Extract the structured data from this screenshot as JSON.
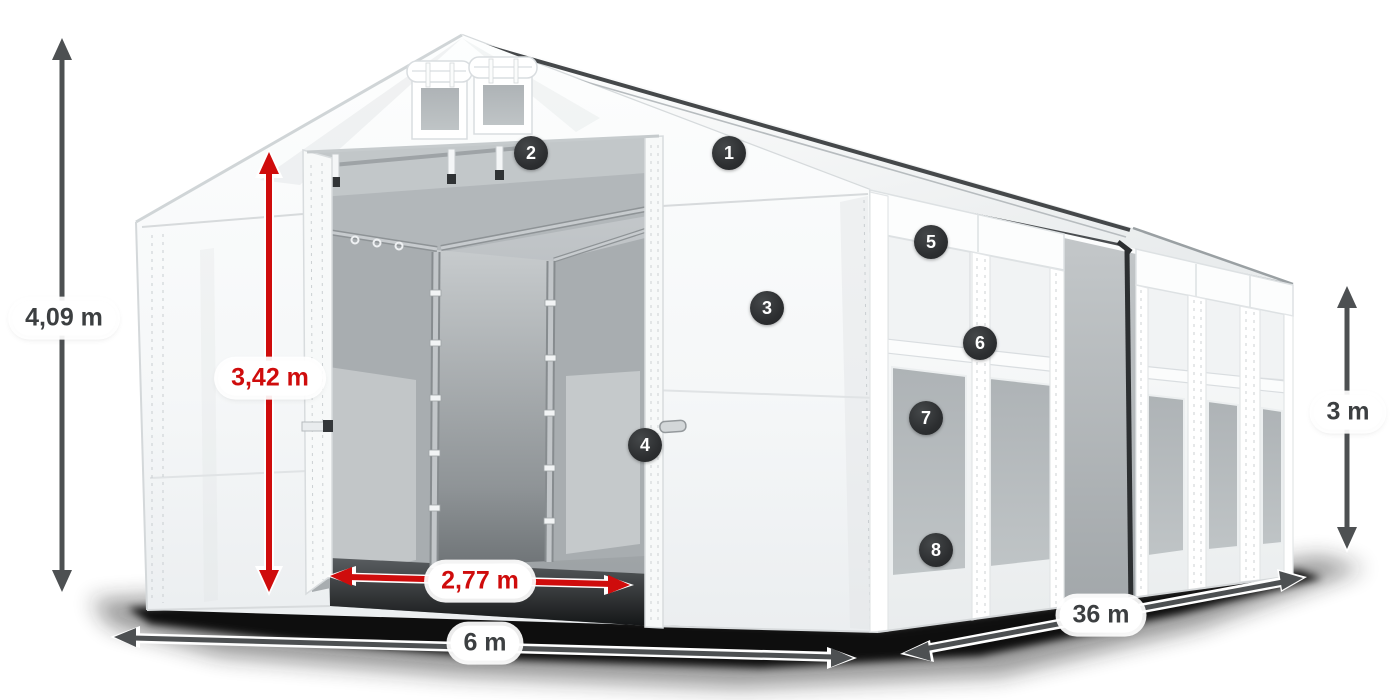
{
  "labels": {
    "total_height": "4,09 m",
    "entrance_height": "3,42 m",
    "entrance_width": "2,77 m",
    "width": "6 m",
    "length": "36 m",
    "side_height": "3 m"
  },
  "callouts": [
    {
      "number": "1"
    },
    {
      "number": "2"
    },
    {
      "number": "3"
    },
    {
      "number": "4"
    },
    {
      "number": "5"
    },
    {
      "number": "6"
    },
    {
      "number": "7"
    },
    {
      "number": "8"
    }
  ],
  "colors": {
    "accent_red": "#cf0c0c",
    "arrow_dark": "#4d5052",
    "badge_background": "#2c2e30",
    "label_text_dark": "#3c3f41"
  }
}
